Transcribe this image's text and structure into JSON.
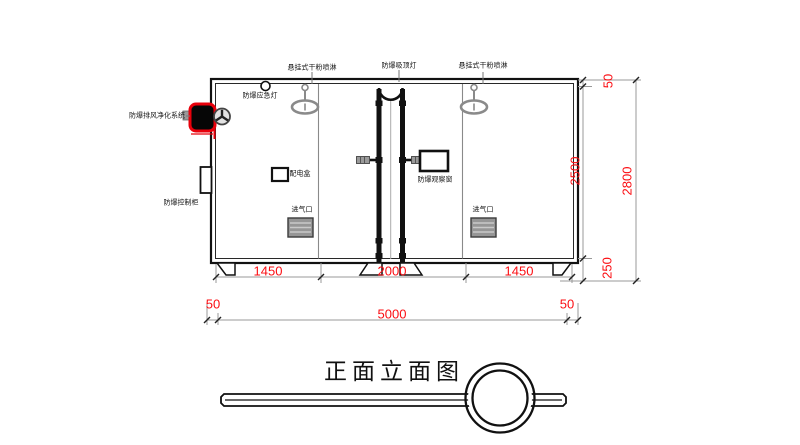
{
  "title": {
    "text": "正面立面图"
  },
  "labels": {
    "sprinkler_left": "悬挂式干粉喷淋",
    "ceiling_lamp": "防爆吸顶灯",
    "sprinkler_right": "悬挂式干粉喷淋",
    "emergency_light": "防爆应急灯",
    "purification_system": "防爆排风净化系统",
    "control_cabinet": "防爆控制柜",
    "power_box": "配电盒",
    "observation_window": "防爆观察窗",
    "air_inlet_left": "进气口",
    "air_inlet_right": "进气口"
  },
  "dims": {
    "bottom_segments": [
      "1450",
      "2000",
      "1450"
    ],
    "bottom_total": "5000",
    "bottom_left_offset": "50",
    "bottom_right_offset": "50",
    "right_top_offset": "50",
    "right_inner_height": "2500",
    "right_base_height": "250",
    "right_total_height": "2800"
  },
  "colors": {
    "dimension_text": "#fb0d12",
    "device_highlight": "#e8000b",
    "line": "#111111",
    "gray": "#8a8a8a"
  }
}
